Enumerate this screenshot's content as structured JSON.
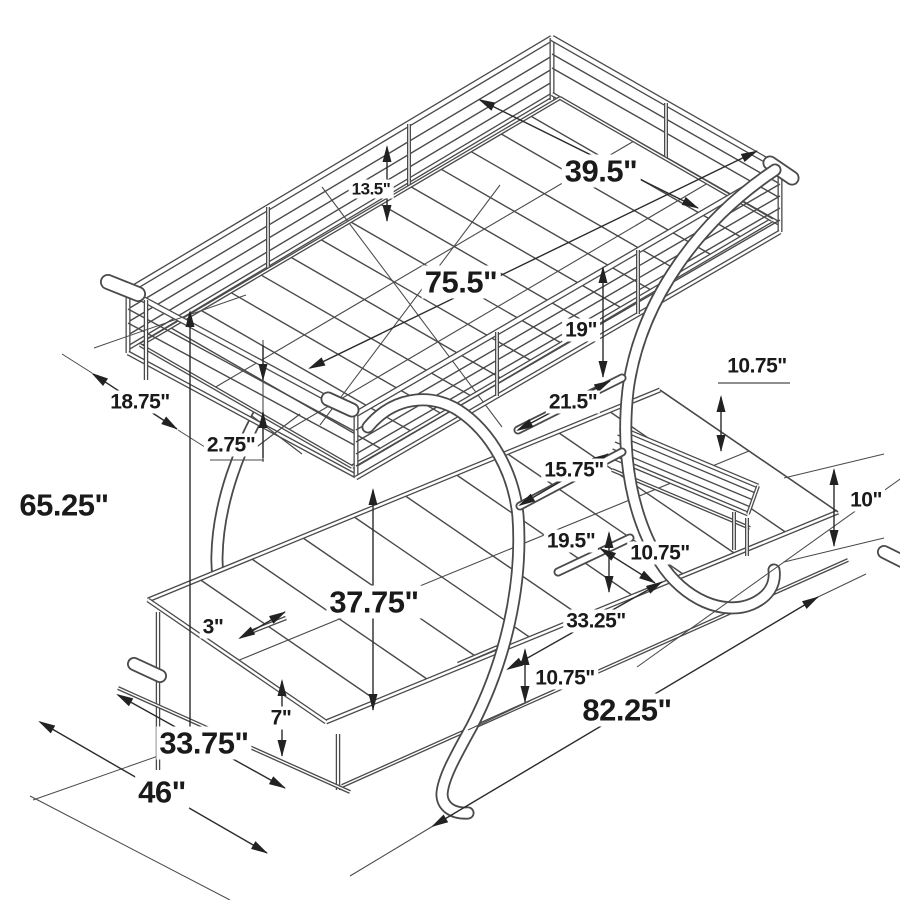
{
  "diagram": {
    "type": "furniture-dimension-drawing",
    "subject": "twin-over-futon C-frame metal bunk bed, isometric line drawing with dimensions",
    "unit": "inches",
    "colors": {
      "background": "#ffffff",
      "line": "#4a4a4a",
      "dimension_line": "#2a2a2a",
      "text": "#1a1a1a"
    },
    "dimensions": {
      "guard_rail_height": {
        "label": "13.5\""
      },
      "bunk_width": {
        "label": "39.5\""
      },
      "bunk_length": {
        "label": "75.5\""
      },
      "rail_to_shelf_gap": {
        "label": "19\""
      },
      "foot_clearance": {
        "label": "18.75\""
      },
      "rail_gap": {
        "label": "2.75\""
      },
      "upper_shelf_length": {
        "label": "21.5\""
      },
      "shelf_drop": {
        "label": "10.75\""
      },
      "middle_shelf_length": {
        "label": "15.75\""
      },
      "bench_height": {
        "label": "10\""
      },
      "shelf_spacing": {
        "label": "19.5\""
      },
      "step_offset": {
        "label": "10.75\""
      },
      "futon_width": {
        "label": "33.25\""
      },
      "floor_offset": {
        "label": "10.75\""
      },
      "under_bunk_clearance": {
        "label": "37.75\""
      },
      "bracket_length": {
        "label": "3\""
      },
      "overall_height": {
        "label": "65.25\""
      },
      "futon_frame_height": {
        "label": "7\""
      },
      "futon_section_length": {
        "label": "33.75\""
      },
      "overall_width": {
        "label": "46\""
      },
      "overall_length": {
        "label": "82.25\""
      }
    }
  }
}
